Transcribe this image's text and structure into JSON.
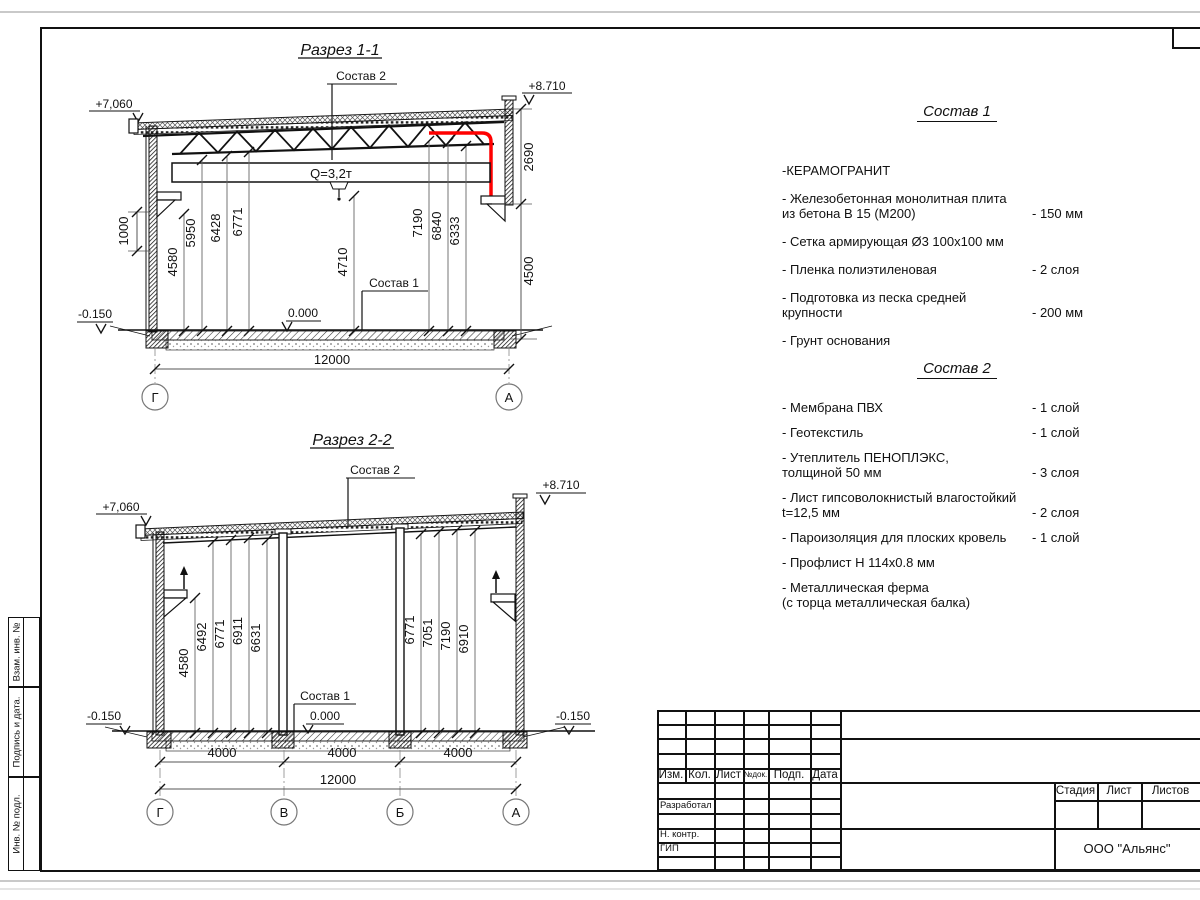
{
  "s1": {
    "title": "Разрез 1-1",
    "lbl1": "Состав 1",
    "lbl2": "Состав 2",
    "crane": "Q=3,2т",
    "elev_top": "+8.710",
    "elev_left": "+7,060",
    "zero": "0.000",
    "minus": "-0.150",
    "d1000": "1000",
    "d2690": "2690",
    "d4500": "4500",
    "total": "12000",
    "ax_l": "Г",
    "ax_r": "А",
    "v": [
      "4580",
      "5950",
      "6428",
      "6771",
      "4710",
      "7190",
      "6840",
      "6333"
    ]
  },
  "s2": {
    "title": "Разрез 2-2",
    "lbl1": "Состав 1",
    "lbl2": "Состав 2",
    "elev_top": "+8.710",
    "elev_left": "+7,060",
    "zero": "0.000",
    "minus_l": "-0.150",
    "minus_r": "-0.150",
    "span": "4000",
    "total": "12000",
    "axes": [
      "Г",
      "В",
      "Б",
      "А"
    ],
    "vl": [
      "4580",
      "6492",
      "6771",
      "6911",
      "6631"
    ],
    "vr": [
      "6771",
      "7051",
      "7190",
      "6910"
    ]
  },
  "spec1": {
    "heading": "Состав 1",
    "items": [
      {
        "name": "-КЕРАМОГРАНИТ",
        "value": ""
      },
      {
        "name": "- Железобетонная  монолитная плита\nиз бетона В 15 (М200)",
        "value": "- 150 мм"
      },
      {
        "name": "- Сетка армирующая Ø3 100x100 мм",
        "value": ""
      },
      {
        "name": "- Пленка полиэтиленовая",
        "value": "-  2 слоя"
      },
      {
        "name": "- Подготовка из песка средней\nкрупности",
        "value": "- 200 мм"
      },
      {
        "name": "- Грунт основания",
        "value": ""
      }
    ]
  },
  "spec2": {
    "heading": "Состав 2",
    "items": [
      {
        "name": "- Мембрана ПВХ",
        "value": "- 1 слой"
      },
      {
        "name": "- Геотекстиль",
        "value": "- 1 слой"
      },
      {
        "name": "- Утеплитель ПЕНОПЛЭКС,\nтолщиной 50 мм",
        "value": "- 3 слоя"
      },
      {
        "name": "- Лист гипсоволокнистый влагостойкий\nt=12,5 мм",
        "value": "- 2 слоя"
      },
      {
        "name": "- Пароизоляция для плоских кровель",
        "value": "- 1 слой"
      },
      {
        "name": "- Профлист Н 114x0.8 мм",
        "value": ""
      },
      {
        "name": "- Металлическая ферма\n(с торца металлическая балка)",
        "value": ""
      }
    ]
  },
  "titleblock": {
    "cols": [
      "Изм.",
      "Кол.",
      "Лист",
      "№док.",
      "Подп.",
      "Дата"
    ],
    "row_labels": [
      "Разработал",
      "Н. контр.",
      "ГИП"
    ],
    "stage": [
      "Стадия",
      "Лист",
      "Листов"
    ],
    "company": "ООО \"Альянс\""
  },
  "stamp": {
    "labels": [
      "Взам. инв. №",
      "Подпись  и  дата.",
      "Инв. № подл."
    ]
  },
  "colors": {
    "accent_red": "#ff0000",
    "line": "#1a1a1a"
  }
}
